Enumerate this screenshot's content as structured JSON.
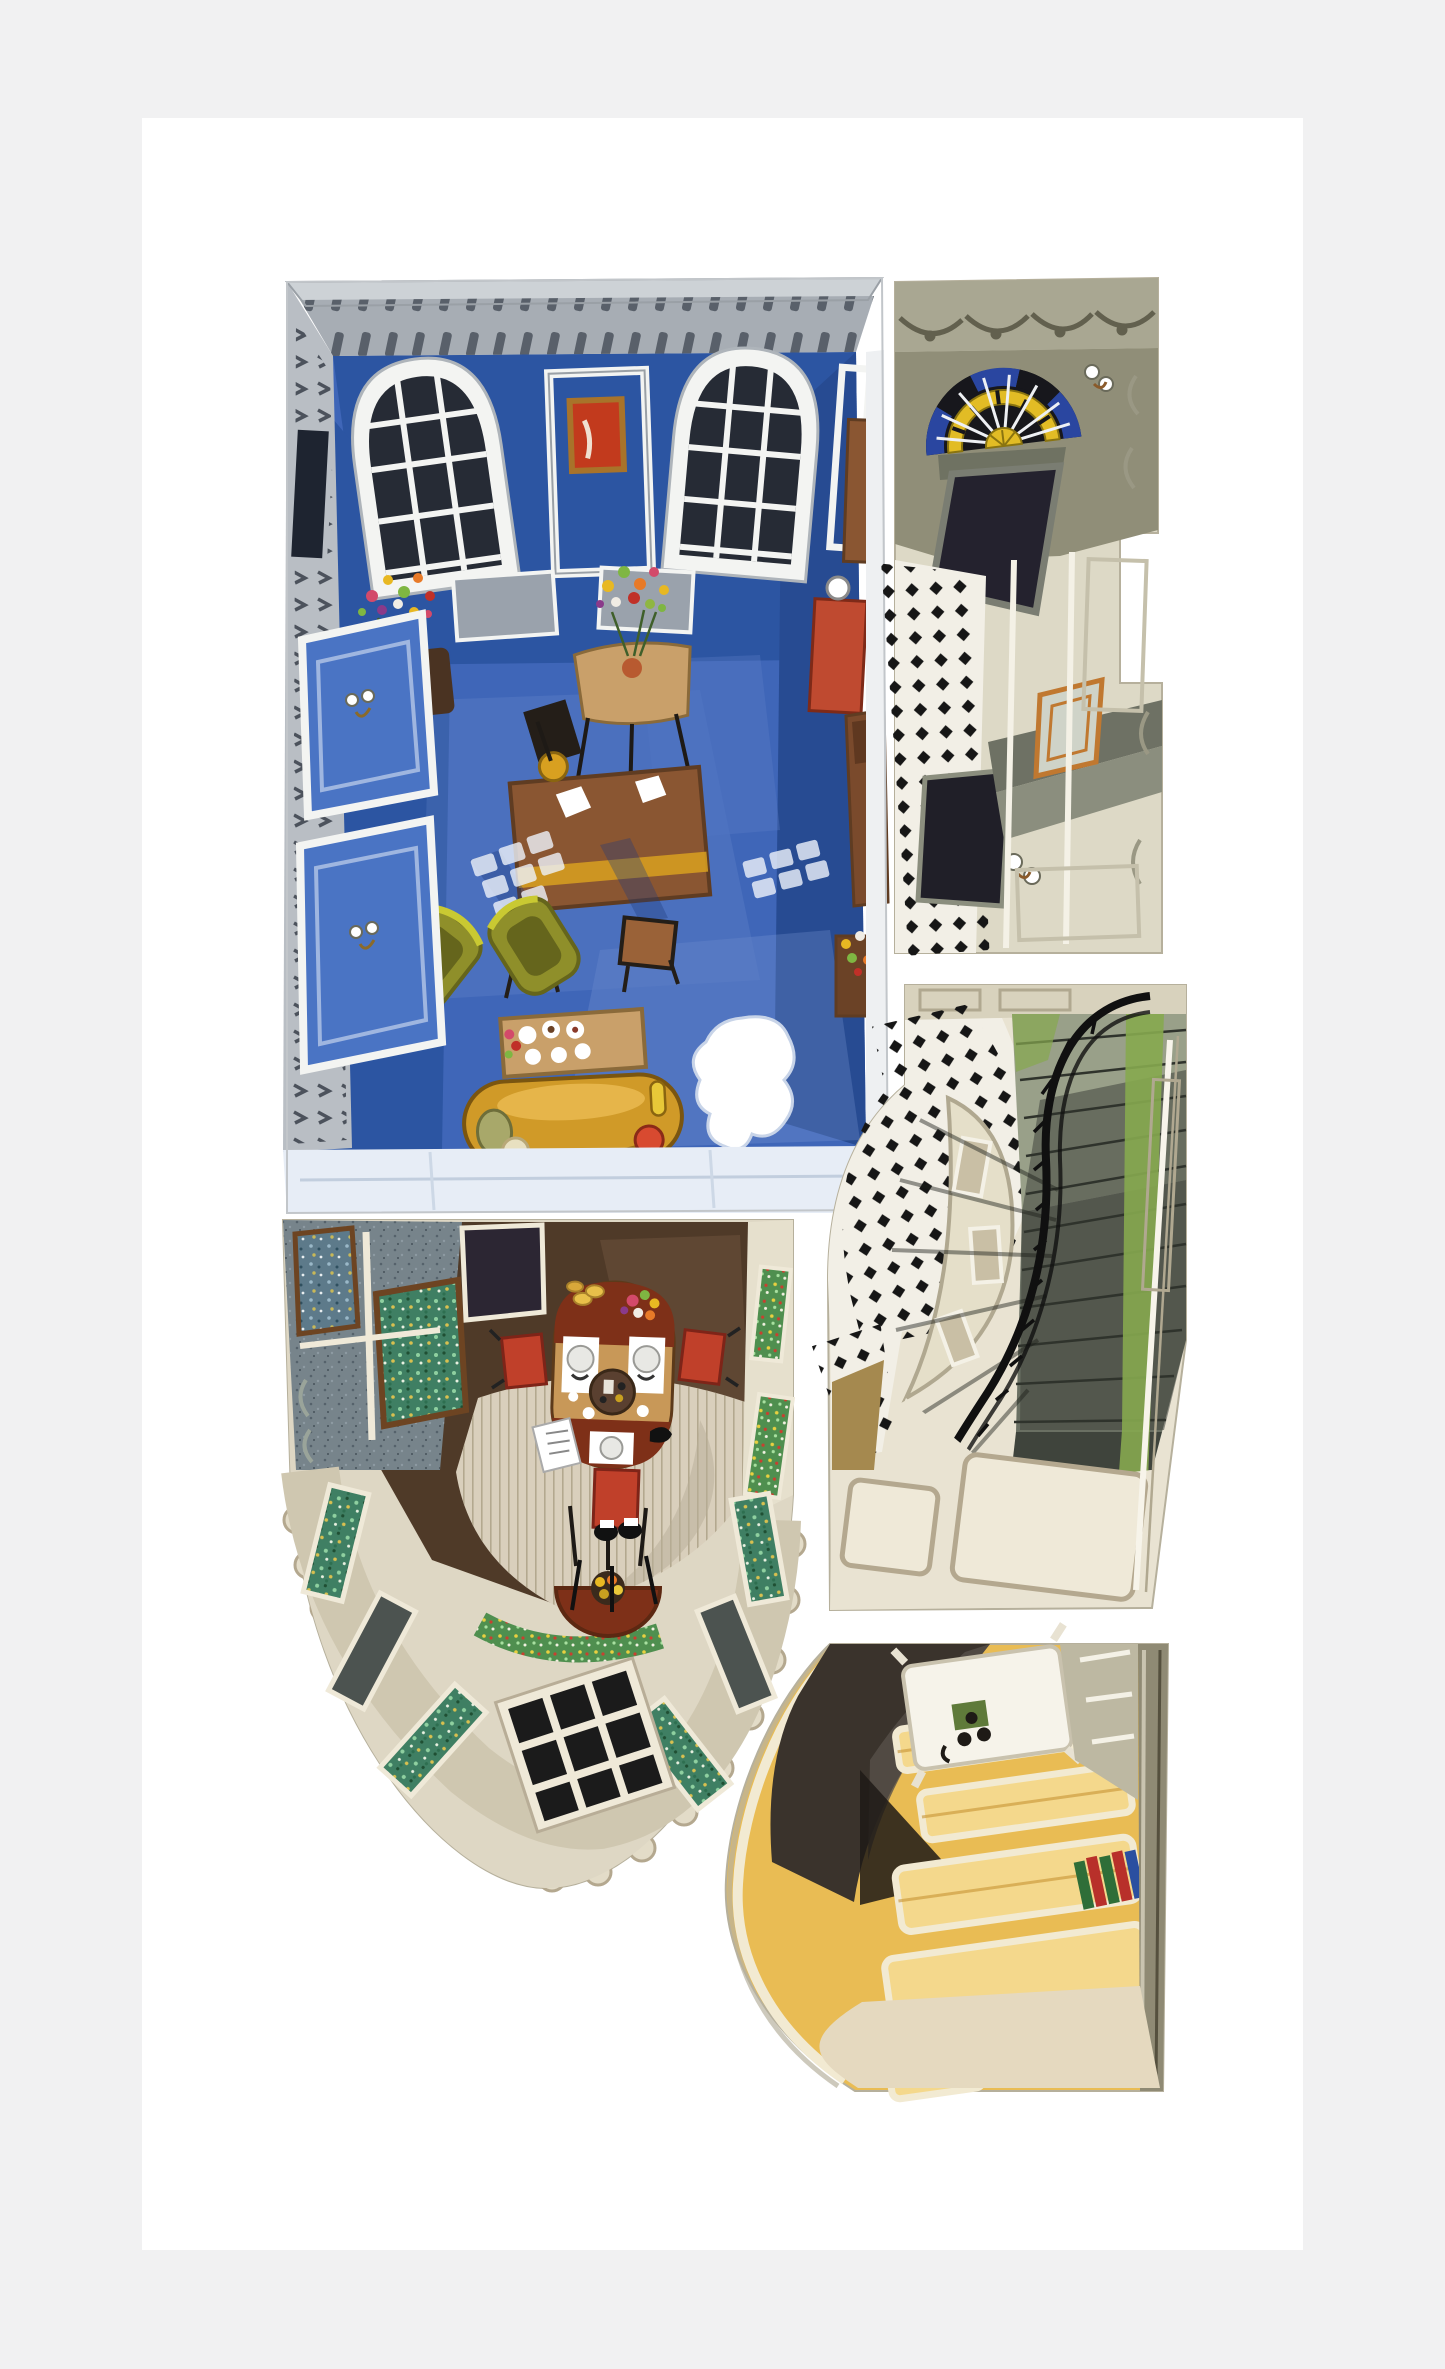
{
  "artwork": {
    "kind": "watercolor aerial cutaway illustration of a townhouse interior",
    "panels": [
      {
        "id": "drawing-room",
        "description": "cobalt blue drawing room with arched windows, desk, armchairs, mustard sofa"
      },
      {
        "id": "entrance-hall",
        "description": "olive hallway with stained-glass fanlight and chequered floor"
      },
      {
        "id": "stairwell",
        "description": "curved staircase with black iron balustrade and green runner"
      },
      {
        "id": "dining-room",
        "description": "dining room with oval table and stained-glass bow window"
      },
      {
        "id": "kitchen-passage",
        "description": "warm yellow panelled lower passage with table and books"
      }
    ]
  },
  "palette": {
    "page-bg": "#f1f1f2",
    "artboard": "#ffffff",
    "panel-edge": "#b9bdb6",
    "cornice-gray": "#a7adb4",
    "cornice-light": "#cdd2d6",
    "dentil-dark": "#59606a",
    "frame-white": "#f3f4f2",
    "frame-gray": "#b9bec4",
    "blue-wall": "#2c55a2",
    "blue-wall-deep": "#274b92",
    "blue-floor": "#3f66b8",
    "blue-floor-light": "#7f9bd8",
    "blue-pale": "#e7edf6",
    "pane-dark": "#262b35",
    "picture-red": "#c23a1d",
    "gilt": "#a8732a",
    "wood-brown": "#8a5632",
    "wood-dark": "#5f3c22",
    "wood-tan": "#c9a06a",
    "lamp-yellow": "#d8a020",
    "olive-chair": "#8f8f2a",
    "olive-chair-dark": "#65651c",
    "olive-highlight": "#c9c932",
    "sofa-mustard": "#d09a28",
    "sofa-shadow": "#9a6d14",
    "cushion-red": "#d84a30",
    "cushion-sage": "#a8a86a",
    "cushion-cream": "#e8e0c0",
    "rug-brown": "#8d7355",
    "red-cabinet": "#bf4a30",
    "hall-wall": "#a9a792",
    "hall-wall-dark": "#908e78",
    "hall-cream": "#ddd9c6",
    "swag-dark": "#62604e",
    "fan-yellow": "#e2bc25",
    "fan-blue": "#2a46a0",
    "fan-black": "#17171c",
    "door-navy": "#24222e",
    "check-white": "#f2efe6",
    "check-black": "#161616",
    "stair-tread-light": "#99a089",
    "stair-tread-mid": "#6a7063",
    "stair-tread-dark": "#3f443c",
    "stair-green": "#86a84f",
    "rail-black": "#101010",
    "landing-cream": "#e9e3d2",
    "landing-line": "#b4a88f",
    "tan-wedge": "#a5894f",
    "dining-floor": "#4f3a28",
    "dining-floor-light": "#6b503a",
    "sg-teal": "#3f7f63",
    "sg-frame-brown": "#6d4422",
    "wall-speckle": "#77848b",
    "table-mahogany": "#7e3018",
    "table-tan": "#c89858",
    "chair-red": "#c0402a",
    "rug-cream": "#d9cfbc",
    "rug-stripe": "#b3a88f",
    "kitchen-yellow": "#e9bc54",
    "kitchen-yellow-light": "#f4d88c",
    "kitchen-cream": "#f2ead2",
    "kitchen-shadow": "#3a332c",
    "kitchen-wall-olive": "#8f8a74",
    "book-green": "#2f6e38",
    "book-red": "#b8302a",
    "book-blue": "#2a4fa0"
  }
}
